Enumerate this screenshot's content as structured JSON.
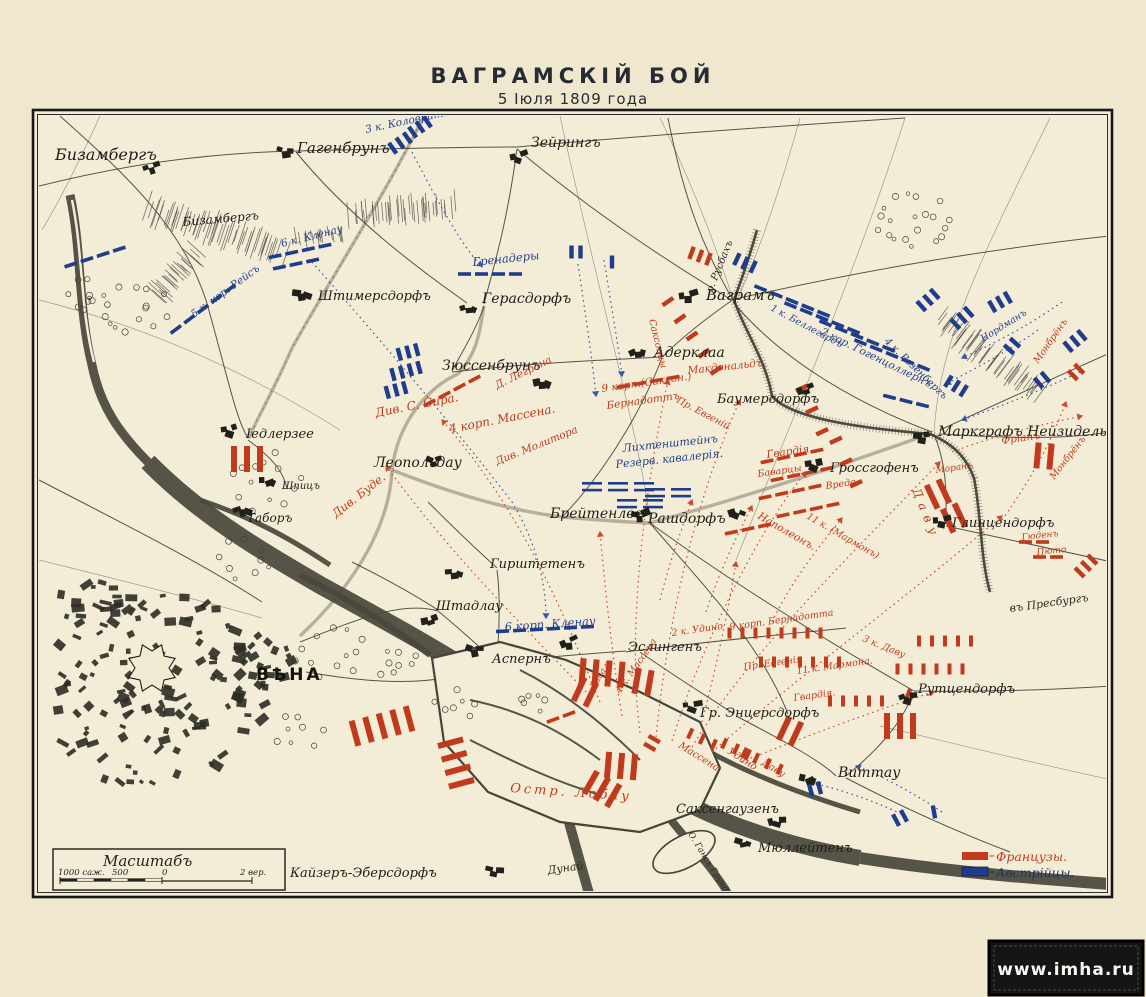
{
  "page": {
    "title": "ВАГРАМСКІЙ БОЙ",
    "subtitle": "5 Іюля 1809 года",
    "watermark": "www.imha.ru"
  },
  "legend": {
    "french": "Французы.",
    "austrian": "Австрійцы."
  },
  "scale": {
    "heading": "Масштабъ",
    "labels": [
      "1000 саж.",
      "500",
      "0",
      "2 вер."
    ]
  },
  "colors": {
    "french": "#c13a1d",
    "austrian": "#1f3d8c",
    "paper": "#f3edd8",
    "ink": "#23221c"
  },
  "map": {
    "towns": [
      {
        "t": "Бизамбергъ",
        "x": 55,
        "y": 160,
        "s": 16,
        "sym": [
          150,
          168
        ]
      },
      {
        "t": "Бизамбергъ",
        "x": 183,
        "y": 226,
        "s": 12,
        "r": -5
      },
      {
        "t": "Гагенбрунъ",
        "x": 297,
        "y": 153,
        "s": 15,
        "sym": [
          283,
          152
        ]
      },
      {
        "t": "Зейрингъ",
        "x": 531,
        "y": 147,
        "s": 14,
        "sym": [
          517,
          157
        ]
      },
      {
        "t": "Штимерсдорфъ",
        "x": 318,
        "y": 300,
        "s": 13,
        "sym": [
          299,
          294
        ]
      },
      {
        "t": "Герасдорфъ",
        "x": 482,
        "y": 303,
        "s": 14,
        "sym": [
          467,
          308
        ]
      },
      {
        "t": "Зюссенбрунъ",
        "x": 442,
        "y": 370,
        "s": 14,
        "sym": [
          540,
          382
        ]
      },
      {
        "t": "Іедлерзее",
        "x": 246,
        "y": 438,
        "s": 13,
        "sym": [
          228,
          430
        ]
      },
      {
        "t": "Леопольдау",
        "x": 374,
        "y": 467,
        "s": 14,
        "sym": [
          432,
          462
        ]
      },
      {
        "t": "Шпицъ",
        "x": 282,
        "y": 489,
        "s": 10,
        "sym": [
          266,
          481
        ]
      },
      {
        "t": "Таборъ",
        "x": 247,
        "y": 522,
        "s": 12,
        "sym": [
          240,
          510
        ]
      },
      {
        "t": "Брейтенлее",
        "x": 550,
        "y": 518,
        "s": 14,
        "sym": [
          638,
          516
        ]
      },
      {
        "t": "Рашдорфъ",
        "x": 648,
        "y": 523,
        "s": 14,
        "sym": [
          735,
          512
        ]
      },
      {
        "t": "Гирштетенъ",
        "x": 490,
        "y": 568,
        "s": 13,
        "sym": [
          452,
          573
        ]
      },
      {
        "t": "Штадлау",
        "x": 436,
        "y": 610,
        "s": 13,
        "sym": [
          428,
          621
        ]
      },
      {
        "t": "Аспернъ",
        "x": 492,
        "y": 663,
        "s": 13,
        "sym": [
          472,
          650
        ]
      },
      {
        "t": "Эслингенъ",
        "x": 628,
        "y": 651,
        "s": 13,
        "sym": [
          567,
          643
        ]
      },
      {
        "t": "Гр. Энцерсдорфъ",
        "x": 700,
        "y": 717,
        "s": 13,
        "sym": [
          690,
          706
        ]
      },
      {
        "t": "ВѢНА",
        "x": 256,
        "y": 680,
        "s": 17,
        "cls": "city"
      },
      {
        "t": "Ваграмъ",
        "x": 706,
        "y": 300,
        "s": 15,
        "sym": [
          686,
          296
        ]
      },
      {
        "t": "Адерклаа",
        "x": 654,
        "y": 357,
        "s": 14,
        "sym": [
          636,
          352
        ]
      },
      {
        "t": "Баумерсдорфъ",
        "x": 717,
        "y": 403,
        "s": 13,
        "sym": [
          804,
          390
        ]
      },
      {
        "t": "Маркграфъ Нейзидель",
        "x": 938,
        "y": 436,
        "s": 14,
        "sym": [
          920,
          437
        ]
      },
      {
        "t": "Гроссгофенъ",
        "x": 830,
        "y": 472,
        "s": 13,
        "sym": [
          812,
          464
        ]
      },
      {
        "t": "Глинцендорфъ",
        "x": 952,
        "y": 527,
        "s": 13,
        "sym": [
          940,
          521
        ]
      },
      {
        "t": "Рутцендорфъ",
        "x": 918,
        "y": 693,
        "s": 13,
        "sym": [
          906,
          697
        ]
      },
      {
        "t": "Виттау",
        "x": 838,
        "y": 777,
        "s": 14,
        "sym": [
          806,
          779
        ]
      },
      {
        "t": "Саксенгаузенъ",
        "x": 676,
        "y": 813,
        "s": 13,
        "sym": [
          775,
          821
        ]
      },
      {
        "t": "Мюллейтенъ",
        "x": 758,
        "y": 852,
        "s": 13,
        "sym": [
          741,
          843
        ]
      },
      {
        "t": "Кайзеръ-Эберсдорфъ",
        "x": 290,
        "y": 877,
        "s": 13,
        "sym": [
          492,
          871
        ]
      }
    ],
    "geo_labels": [
      {
        "t": "Дунай",
        "x": 548,
        "y": 874,
        "s": 11,
        "r": -8
      },
      {
        "t": "р. Русбахъ",
        "x": 712,
        "y": 293,
        "s": 10,
        "r": -68
      },
      {
        "t": "О. Гансъ Грундъ",
        "x": 688,
        "y": 834,
        "s": 8.5,
        "r": 58
      },
      {
        "t": "въ Пресбургъ",
        "x": 1010,
        "y": 612,
        "s": 11,
        "r": -8
      }
    ],
    "labels_au": [
      {
        "t": "3 к. Коловрата",
        "x": 366,
        "y": 133,
        "s": 10.5,
        "r": -12
      },
      {
        "t": "6 к. Кленау",
        "x": 282,
        "y": 247,
        "s": 10.5,
        "r": -14
      },
      {
        "t": "5 к. кор. Рейсъ",
        "x": 194,
        "y": 318,
        "s": 10.5,
        "r": -36
      },
      {
        "t": "Гренадеры",
        "x": 473,
        "y": 266,
        "s": 11.5,
        "r": -6
      },
      {
        "t": "1 к. Беллегардъ",
        "x": 770,
        "y": 310,
        "s": 9.5,
        "r": 28
      },
      {
        "t": "2 кор. Гогенцоллернъ",
        "x": 820,
        "y": 334,
        "s": 10.5,
        "r": 26
      },
      {
        "t": "4 к. Розенбергъ",
        "x": 884,
        "y": 342,
        "s": 10,
        "r": 44
      },
      {
        "t": "Лихтенштейнъ",
        "x": 623,
        "y": 452,
        "s": 11,
        "r": -6
      },
      {
        "t": "Резерв. кавалерія.",
        "x": 616,
        "y": 468,
        "s": 11,
        "r": -6
      },
      {
        "t": "6 корп. Кленау",
        "x": 505,
        "y": 631,
        "s": 11.5,
        "r": -4
      },
      {
        "t": "Нордманъ",
        "x": 983,
        "y": 342,
        "s": 9.5,
        "r": -32
      }
    ],
    "labels_fr": [
      {
        "t": "Див. С. Сира.",
        "x": 376,
        "y": 417,
        "s": 12,
        "r": -11
      },
      {
        "t": "4 корп. Массена.",
        "x": 450,
        "y": 433,
        "s": 12,
        "r": -11
      },
      {
        "t": "Д. Леграна",
        "x": 497,
        "y": 389,
        "s": 10.5,
        "r": -26
      },
      {
        "t": "Див. Молитора",
        "x": 497,
        "y": 465,
        "s": 10.5,
        "r": -22
      },
      {
        "t": "Див. Буде.",
        "x": 336,
        "y": 518,
        "s": 11.5,
        "r": -38
      },
      {
        "t": "Саксонцы",
        "x": 649,
        "y": 320,
        "s": 9.5,
        "r": 76
      },
      {
        "t": "Макдональдъ.",
        "x": 688,
        "y": 374,
        "s": 10.5,
        "r": -6
      },
      {
        "t": "9 корп.(Саксон.)",
        "x": 602,
        "y": 392,
        "s": 10.5,
        "r": -8
      },
      {
        "t": "Бернадоттъ",
        "x": 607,
        "y": 409,
        "s": 10.5,
        "r": -8
      },
      {
        "t": "Пр. Евгеній",
        "x": 676,
        "y": 402,
        "s": 9.5,
        "r": 28
      },
      {
        "t": "Фріанъ",
        "x": 1002,
        "y": 444,
        "s": 10.5,
        "r": -8
      },
      {
        "t": "Монбрёнъ",
        "x": 1038,
        "y": 364,
        "s": 9.5,
        "r": -55
      },
      {
        "t": "Монбрёнъ",
        "x": 1054,
        "y": 480,
        "s": 9.5,
        "r": -52
      },
      {
        "t": "Гвардія.",
        "x": 767,
        "y": 458,
        "s": 10.5,
        "r": -8
      },
      {
        "t": "Баварцы",
        "x": 758,
        "y": 477,
        "s": 9.5,
        "r": -8
      },
      {
        "t": "Вреде.",
        "x": 826,
        "y": 489,
        "s": 9.5,
        "r": -8
      },
      {
        "t": "Наполеонъ.",
        "x": 757,
        "y": 518,
        "s": 10.5,
        "r": 30
      },
      {
        "t": "11 к. (Мармонъ)",
        "x": 806,
        "y": 518,
        "s": 9.5,
        "r": 30
      },
      {
        "t": "Даву",
        "x": 912,
        "y": 490,
        "s": 12,
        "r": 68,
        "ls": 6
      },
      {
        "t": "Моранъ",
        "x": 936,
        "y": 473,
        "s": 9,
        "r": -8
      },
      {
        "t": "Гюденъ",
        "x": 1022,
        "y": 540,
        "s": 9,
        "r": -6
      },
      {
        "t": "Пюто",
        "x": 1037,
        "y": 555,
        "s": 9,
        "r": -6
      },
      {
        "t": "2 к. Удино",
        "x": 672,
        "y": 636,
        "s": 9.5,
        "r": -8
      },
      {
        "t": "9 корп. Бернадотта",
        "x": 730,
        "y": 630,
        "s": 9.5,
        "r": -8
      },
      {
        "t": "3 к. Даву",
        "x": 862,
        "y": 641,
        "s": 9.5,
        "r": 22
      },
      {
        "t": "Пр. Евгенія",
        "x": 744,
        "y": 670,
        "s": 9.5,
        "r": -8
      },
      {
        "t": "11 к. Мармона.",
        "x": 797,
        "y": 674,
        "s": 9.5,
        "r": -8
      },
      {
        "t": "Гвардія.",
        "x": 794,
        "y": 701,
        "s": 9.5,
        "r": -8
      },
      {
        "t": "Ласаль",
        "x": 594,
        "y": 690,
        "s": 9,
        "r": -58
      },
      {
        "t": "4 к. Массена",
        "x": 620,
        "y": 694,
        "s": 9.5,
        "r": -55
      },
      {
        "t": "Массена",
        "x": 678,
        "y": 747,
        "s": 10,
        "r": 32
      },
      {
        "t": "Удино",
        "x": 727,
        "y": 753,
        "s": 10,
        "r": 32
      },
      {
        "t": "Даву",
        "x": 761,
        "y": 764,
        "s": 10,
        "r": 32
      },
      {
        "t": "Остр.  Лобау",
        "x": 510,
        "y": 792,
        "s": 13,
        "r": 4,
        "ls": 3
      }
    ],
    "units": [
      [
        "a",
        "bar",
        400,
        143,
        -35,
        3
      ],
      [
        "a",
        "bar",
        420,
        127,
        -35,
        3
      ],
      [
        "a",
        "dash",
        95,
        257,
        -18,
        4
      ],
      [
        "a",
        "dash",
        300,
        251,
        -12,
        4
      ],
      [
        "a",
        "dash",
        296,
        264,
        -12,
        3
      ],
      [
        "a",
        "dash",
        203,
        309,
        -37,
        5
      ],
      [
        "a",
        "bar",
        408,
        352,
        -15,
        3
      ],
      [
        "a",
        "bar",
        406,
        371,
        -15,
        4
      ],
      [
        "a",
        "bar",
        396,
        390,
        -15,
        3
      ],
      [
        "a",
        "dash",
        490,
        274,
        0,
        4
      ],
      [
        "a",
        "bar",
        576,
        252,
        0,
        2
      ],
      [
        "a",
        "bar",
        612,
        262,
        0,
        1
      ],
      [
        "a",
        "bar",
        745,
        263,
        25,
        3
      ],
      [
        "a",
        "dash",
        792,
        301,
        22,
        5
      ],
      [
        "a",
        "dash",
        822,
        318,
        22,
        5
      ],
      [
        "a",
        "dash",
        857,
        336,
        22,
        5
      ],
      [
        "a",
        "dash",
        892,
        355,
        22,
        5
      ],
      [
        "a",
        "bar",
        928,
        300,
        -42,
        3
      ],
      [
        "a",
        "bar",
        962,
        318,
        -42,
        3
      ],
      [
        "a",
        "bar",
        1000,
        302,
        -30,
        3
      ],
      [
        "a",
        "bar",
        1012,
        346,
        -48,
        2
      ],
      [
        "a",
        "bar",
        956,
        386,
        32,
        3
      ],
      [
        "a",
        "dash",
        906,
        401,
        14,
        3
      ],
      [
        "a",
        "cav",
        618,
        487,
        0,
        3
      ],
      [
        "a",
        "cav",
        668,
        493,
        0,
        2
      ],
      [
        "a",
        "cav",
        640,
        504,
        0,
        2
      ],
      [
        "a",
        "dash",
        545,
        629,
        -3,
        6
      ],
      [
        "a",
        "bar",
        815,
        789,
        -15,
        2
      ],
      [
        "a",
        "bar",
        900,
        818,
        -28,
        2
      ],
      [
        "a",
        "bar",
        934,
        812,
        -10,
        1
      ],
      [
        "a",
        "bar",
        1075,
        341,
        -40,
        3
      ],
      [
        "a",
        "bar",
        1042,
        380,
        -40,
        2
      ],
      [
        "f",
        "tall",
        247,
        459,
        0,
        3
      ],
      [
        "f",
        "dash",
        452,
        391,
        -28,
        4
      ],
      [
        "f",
        "bar",
        692,
        336,
        55,
        5,
        21
      ],
      [
        "f",
        "bar",
        700,
        256,
        20,
        3
      ],
      [
        "f",
        "dash",
        648,
        382,
        -10,
        4
      ],
      [
        "f",
        "bar",
        812,
        410,
        65,
        3,
        24
      ],
      [
        "f",
        "bar",
        846,
        462,
        65,
        3,
        24
      ],
      [
        "f",
        "dash",
        792,
        456,
        -12,
        4
      ],
      [
        "f",
        "dash",
        802,
        474,
        -12,
        4
      ],
      [
        "f",
        "dash",
        790,
        492,
        -12,
        4
      ],
      [
        "f",
        "dash",
        808,
        510,
        -12,
        4
      ],
      [
        "f",
        "dash",
        748,
        529,
        -12,
        3
      ],
      [
        "f",
        "tall",
        938,
        494,
        -25,
        2
      ],
      [
        "f",
        "tall",
        954,
        518,
        -25,
        2
      ],
      [
        "f",
        "tall",
        1044,
        456,
        5,
        2
      ],
      [
        "f",
        "bar",
        1076,
        372,
        -45,
        2
      ],
      [
        "f",
        "bar",
        1086,
        566,
        -45,
        3
      ],
      [
        "f",
        "dash",
        1034,
        542,
        0,
        2
      ],
      [
        "f",
        "dash",
        1048,
        557,
        0,
        2
      ],
      [
        "f",
        "bar",
        908,
        695,
        20,
        1
      ],
      [
        "f",
        "tall",
        602,
        673,
        5,
        4
      ],
      [
        "f",
        "tall",
        585,
        692,
        25,
        2
      ],
      [
        "f",
        "tall",
        643,
        682,
        10,
        2
      ],
      [
        "f",
        "col",
        775,
        633,
        0,
        8
      ],
      [
        "f",
        "col",
        945,
        641,
        0,
        5
      ],
      [
        "f",
        "col",
        800,
        662,
        0,
        7
      ],
      [
        "f",
        "col",
        930,
        669,
        0,
        6
      ],
      [
        "f",
        "col",
        856,
        701,
        0,
        5
      ],
      [
        "f",
        "tall",
        900,
        726,
        0,
        3
      ],
      [
        "f",
        "tall",
        790,
        731,
        25,
        2
      ],
      [
        "f",
        "col",
        736,
        749,
        25,
        3
      ],
      [
        "f",
        "col",
        762,
        761,
        25,
        4
      ],
      [
        "f",
        "col",
        702,
        739,
        25,
        3
      ],
      [
        "f",
        "tall",
        382,
        726,
        -15,
        5,
        14
      ],
      [
        "f",
        "tall",
        456,
        763,
        75,
        4,
        14
      ],
      [
        "f",
        "tall",
        621,
        766,
        5,
        3
      ],
      [
        "f",
        "tall",
        602,
        789,
        30,
        3
      ],
      [
        "f",
        "dash",
        561,
        717,
        -20,
        2
      ],
      [
        "f",
        "bar",
        652,
        743,
        -60,
        2
      ]
    ],
    "hills": [
      [
        148,
        208,
        282,
        252,
        55,
        15
      ],
      [
        196,
        252,
        156,
        296,
        26,
        11
      ],
      [
        352,
        214,
        452,
        206,
        40,
        12
      ],
      [
        296,
        240,
        344,
        232,
        16,
        8
      ],
      [
        938,
        318,
        1038,
        392,
        48,
        13
      ]
    ],
    "trees": [
      [
        134,
        308,
        36,
        26,
        15
      ],
      [
        86,
        298,
        18,
        22,
        9
      ],
      [
        913,
        220,
        40,
        28,
        20
      ],
      [
        262,
        478,
        40,
        36,
        13
      ],
      [
        330,
        652,
        42,
        26,
        12
      ],
      [
        397,
        664,
        26,
        18,
        8
      ],
      [
        242,
        560,
        30,
        22,
        9
      ],
      [
        455,
        704,
        26,
        16,
        7
      ],
      [
        296,
        730,
        30,
        20,
        8
      ],
      [
        528,
        700,
        20,
        14,
        6
      ]
    ]
  }
}
